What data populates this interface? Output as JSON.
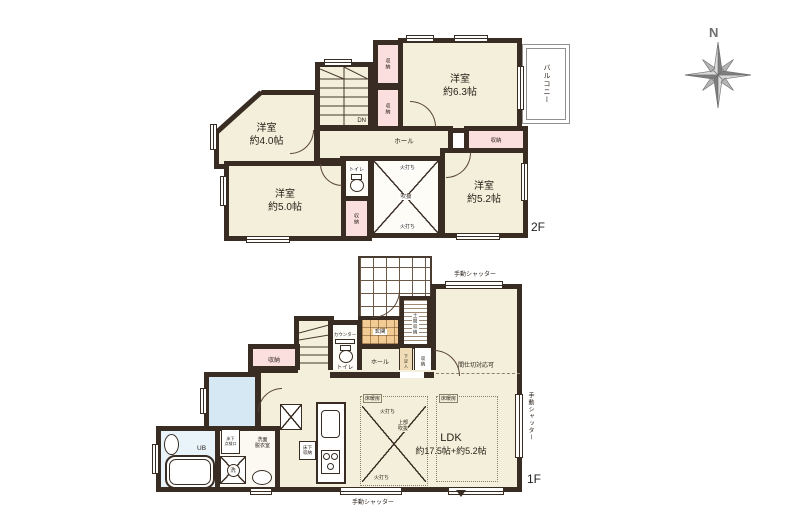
{
  "compass": {
    "north_label": "N"
  },
  "colors": {
    "wall": "#382c23",
    "room_fill": "#f4efda",
    "closet_fill": "#fbdede",
    "entry_tile": "#f2cb94",
    "wet_fill": "#d6e8f4"
  },
  "floor2": {
    "floor_label": "2F",
    "room_6_3": "洋室\n約6.3帖",
    "room_4_0": "洋室\n約4.0帖",
    "room_5_0": "洋室\n約5.0帖",
    "room_5_2": "洋室\n約5.2帖",
    "balcony": "バルコニー",
    "hall": "ホール",
    "toilet": "トイレ",
    "void": "吹抜",
    "fire_brace": "火打ち",
    "storage": "収納",
    "stairs_down": "DN"
  },
  "floor1": {
    "floor_label": "1F",
    "ldk_name": "LDK",
    "ldk_area": "約17.5帖+約5.2帖",
    "entrance": "玄関",
    "entrance_storage": "土間収納",
    "shoe_cabinet": "下足入",
    "hall": "ホール",
    "toilet": "トイレ",
    "toilet_counter": "カウンター",
    "storage": "収納",
    "unit_bath": "UB",
    "washroom": "洗面\n脱衣室",
    "washing_machine": "洗",
    "underfloor_hatch": "床下\n点検口",
    "underfloor_storage": "床下\n収納",
    "upper_void": "上部\n吹抜",
    "fire_brace": "火打ち",
    "floor_heating": "床暖房",
    "manual_shutter": "手動シャッター",
    "partition_ready": "間仕切対応可",
    "stairs_up": "UP"
  }
}
